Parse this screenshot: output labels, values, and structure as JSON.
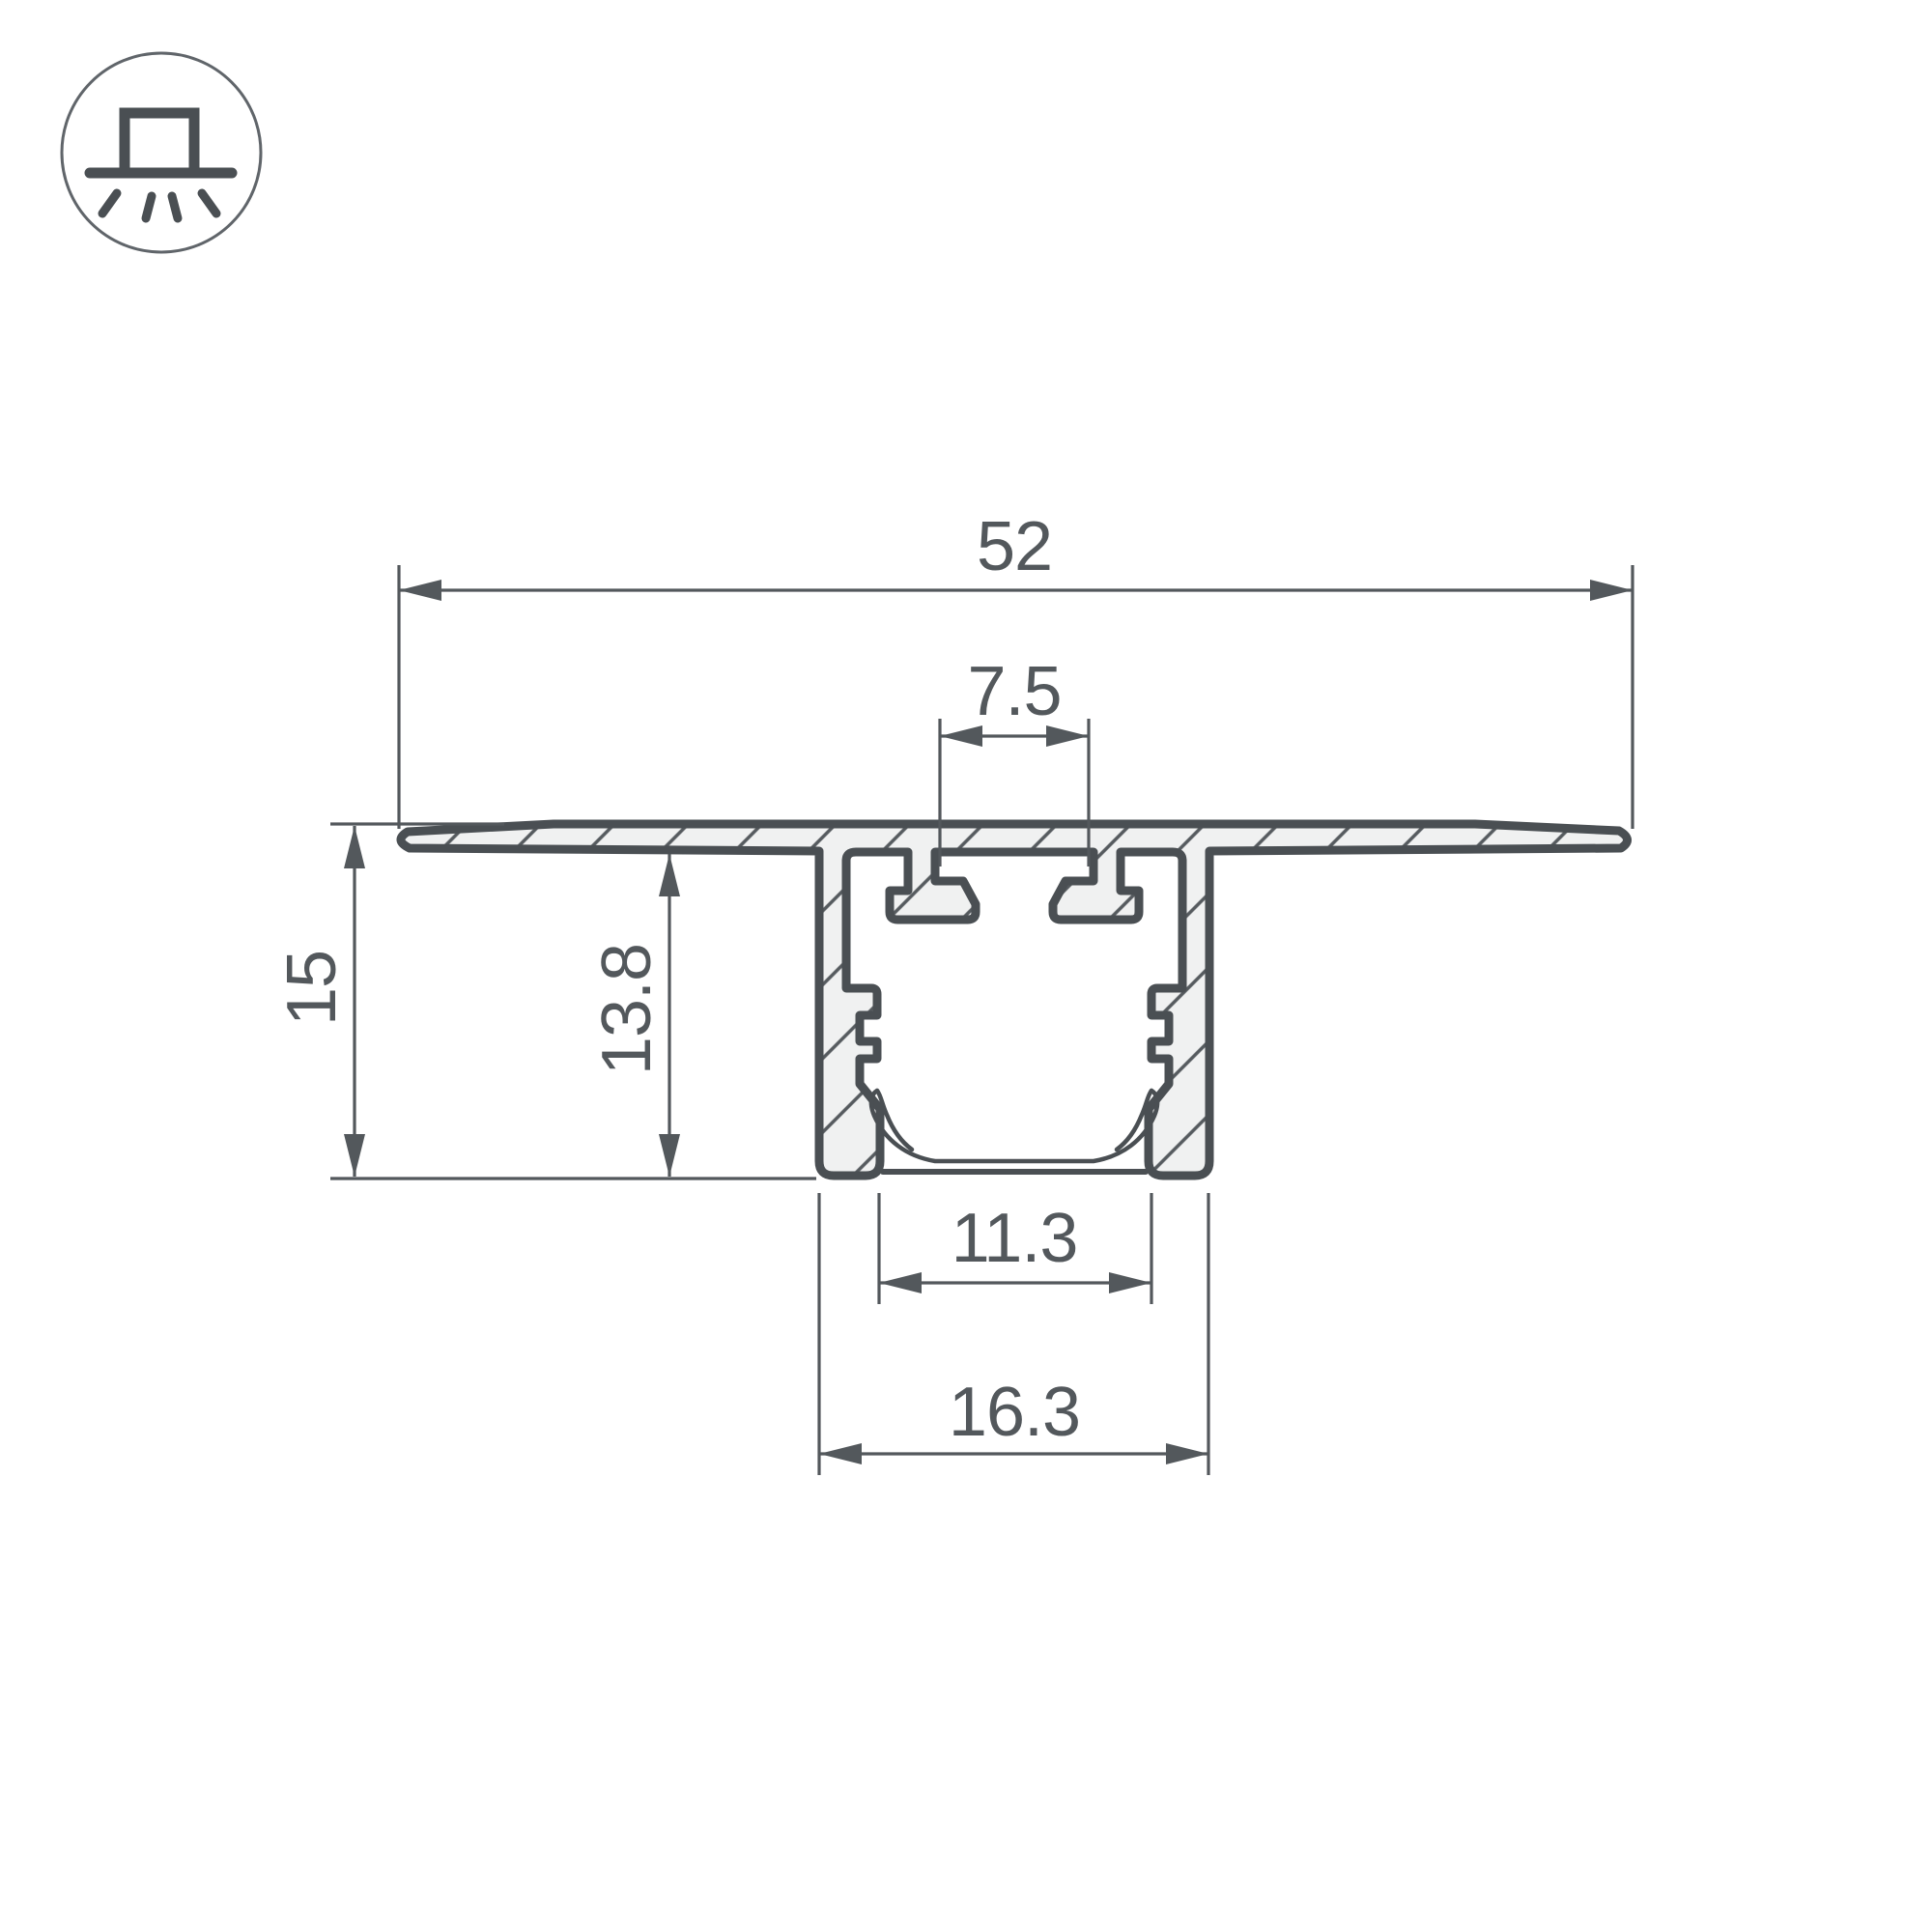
{
  "drawing": {
    "type": "profile-cross-section-dimension-drawing",
    "dims": {
      "total_width": "52",
      "top_slot_width": "7.5",
      "total_height": "15",
      "inner_depth": "13.8",
      "inner_width": "11.3",
      "channel_width": "16.3"
    },
    "icon": "recessed-downlight-symbol"
  },
  "colors": {
    "ink": "#4a4f53",
    "dim": "#53585c",
    "fill": "#f0f1f1",
    "hatch": "#565b5f",
    "icon_stroke": "#60656a",
    "background": "#ffffff"
  }
}
